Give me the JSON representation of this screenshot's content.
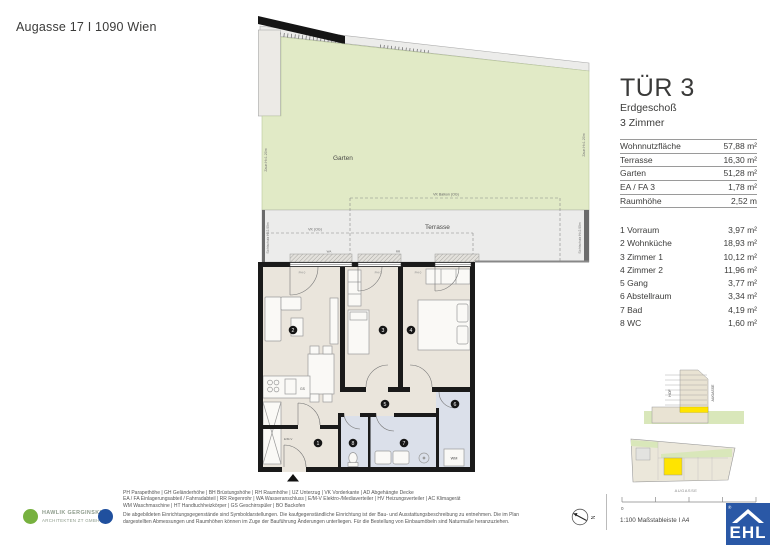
{
  "header": {
    "address": "Augasse 17 I 1090 Wien"
  },
  "unit": {
    "name": "TÜR 3",
    "floor": "Erdgeschoß",
    "rooms": "3 Zimmer",
    "metrics": [
      {
        "label": "Wohnnutzfläche",
        "value": "57,88 m²"
      },
      {
        "label": "Terrasse",
        "value": "16,30 m²"
      },
      {
        "label": "Garten",
        "value": "51,28 m²"
      },
      {
        "label": "EA / FA 3",
        "value": "1,78 m²"
      },
      {
        "label": "Raumhöhe",
        "value": "2,52 m"
      }
    ],
    "room_list": [
      {
        "label": "1 Vorraum",
        "value": "3,97 m²"
      },
      {
        "label": "2 Wohnküche",
        "value": "18,93 m²"
      },
      {
        "label": "3 Zimmer 1",
        "value": "10,12 m²"
      },
      {
        "label": "4 Zimmer 2",
        "value": "11,96 m²"
      },
      {
        "label": "5 Gang",
        "value": "3,77 m²"
      },
      {
        "label": "6 Abstellraum",
        "value": "3,34 m²"
      },
      {
        "label": "7 Bad",
        "value": "4,19 m²"
      },
      {
        "label": "8 WC",
        "value": "1,60 m²"
      }
    ]
  },
  "plan": {
    "garten": "Garten",
    "terrasse": "Terrasse",
    "zaun": "Zaun H=1.20m",
    "sichtschutz": "Sichtschutz H=2.00m",
    "vk_balkon": "VK Balkon (OG)",
    "vk_og": "VK (OG)",
    "ph": "PH 0",
    "wa": "WA",
    "rr": "RR",
    "gs": "GS",
    "emv": "E/M-V",
    "wm": "WM",
    "dim1": "3.06 x 2.30",
    "dim2": "3.06 x 2.30",
    "numbers": [
      "1",
      "2",
      "3",
      "4",
      "5",
      "6",
      "7",
      "8"
    ]
  },
  "diagrams": {
    "hof": "HOF",
    "augasse_section": "AUGASSE",
    "augasse_site": "AUGASSE"
  },
  "scalebar": {
    "zero": "0",
    "label": "1:100 Maßstableiste I A4",
    "north": "N"
  },
  "legend_lines": [
    "PH Parapethöhe | GH Geländerhöhe | BH Brüstungshöhe | RH Raumhöhe | UZ Unterzug | VK Vorderkante | AD Abgehängte Decke",
    "EA / FA Einlagerungsabteil / Fahrradabteil | RR Regenrohr | WA Wasseranschluss | E/M-V Elektro-/Mediaverteiler | HV Heizungsverteiler | AC Klimagerät",
    "WM Waschmaschine | HT Handtuchheizkörper | GS Geschirrspüler | BO Backofen",
    "Die abgebildeten Einrichtungsgegenstände sind Symboldarstellungen. Die kaufgegenständliche Einrichtung ist der Bau- und Ausstattungsbeschreibung zu entnehmen. Die im Plan",
    "dargestellten Abmessungen und Raumhöhen können im Zuge der Bauführung Änderungen unterliegen. Für die Bestellung von Einbaumöbeln sind Naturmaße heranzuziehen."
  ],
  "architect": {
    "name": "HAWLIK GERGINSKI",
    "subtitle": "ARCHITEKTEN ZT GMBH"
  },
  "ehl": {
    "name": "EHL",
    "reg": "®"
  },
  "colors": {
    "garden": "#e1eac6",
    "terrace": "#ececeb",
    "floor": "#eae5dc",
    "wet_room": "#dbe0ea",
    "highlight_yellow": "#ffe400",
    "wall": "#1a1a1a",
    "ehl_blue": "#2a58a6",
    "architect_green": "#77b13f",
    "architect_blue": "#20509e"
  }
}
